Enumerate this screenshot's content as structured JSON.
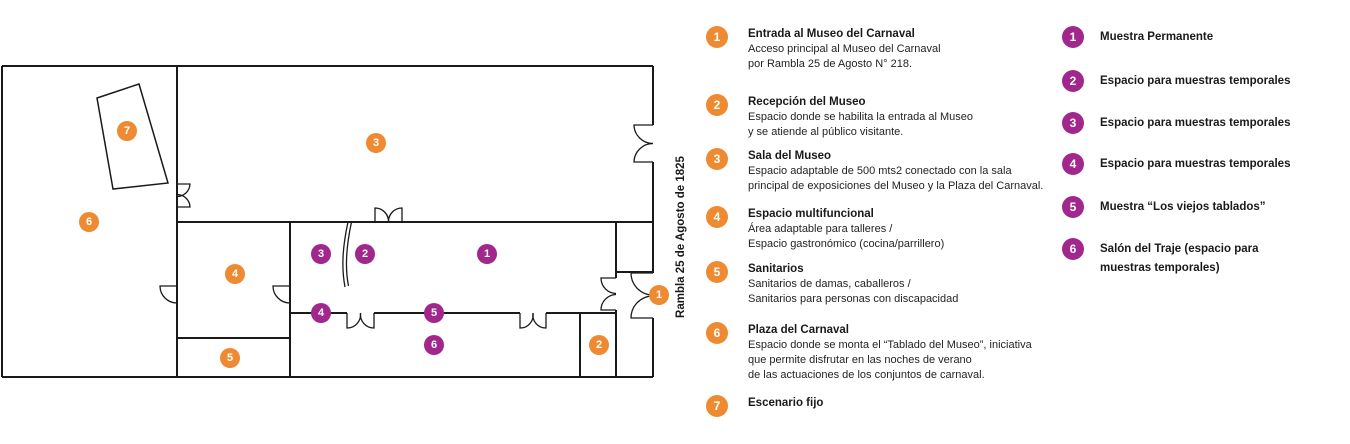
{
  "colors": {
    "orange": "#EE8A31",
    "purple": "#A1278D",
    "wall": "#1a1a1a"
  },
  "plan": {
    "street_label": "Rambla 25 de Agosto de 1825",
    "markers": [
      {
        "group": "orange",
        "label": "1",
        "x": 659,
        "y": 295
      },
      {
        "group": "orange",
        "label": "2",
        "x": 599,
        "y": 345
      },
      {
        "group": "orange",
        "label": "3",
        "x": 376,
        "y": 143
      },
      {
        "group": "orange",
        "label": "4",
        "x": 235,
        "y": 274
      },
      {
        "group": "orange",
        "label": "5",
        "x": 230,
        "y": 358
      },
      {
        "group": "orange",
        "label": "6",
        "x": 89,
        "y": 222
      },
      {
        "group": "orange",
        "label": "7",
        "x": 127,
        "y": 131
      },
      {
        "group": "purple",
        "label": "1",
        "x": 487,
        "y": 254
      },
      {
        "group": "purple",
        "label": "2",
        "x": 365,
        "y": 254
      },
      {
        "group": "purple",
        "label": "3",
        "x": 321,
        "y": 254
      },
      {
        "group": "purple",
        "label": "4",
        "x": 321,
        "y": 313
      },
      {
        "group": "purple",
        "label": "5",
        "x": 434,
        "y": 313
      },
      {
        "group": "purple",
        "label": "6",
        "x": 434,
        "y": 345
      }
    ]
  },
  "legend_orange": {
    "items": [
      {
        "num": "1",
        "title": "Entrada al Museo del Carnaval",
        "desc": [
          "Acceso principal al Museo del Carnaval",
          "por Rambla 25 de Agosto N° 218."
        ]
      },
      {
        "num": "2",
        "title": "Recepción del Museo",
        "desc": [
          "Espacio donde se habilita la entrada al Museo",
          "y se atiende al público visitante."
        ]
      },
      {
        "num": "3",
        "title": "Sala del Museo",
        "desc": [
          "Espacio adaptable de 500 mts2 conectado con la sala",
          "principal de exposiciones del Museo y la Plaza del Carnaval."
        ]
      },
      {
        "num": "4",
        "title": "Espacio multifuncional",
        "desc": [
          "Área adaptable para talleres /",
          "Espacio gastronómico (cocina/parrillero)"
        ]
      },
      {
        "num": "5",
        "title": "Sanitarios",
        "desc": [
          "Sanitarios de damas, caballeros /",
          "Sanitarios para personas con discapacidad"
        ]
      },
      {
        "num": "6",
        "title": "Plaza del Carnaval",
        "desc": [
          "Espacio donde se monta el “Tablado del Museo”, iniciativa",
          "que permite disfrutar en las noches de verano",
          "de las actuaciones de los conjuntos de carnaval."
        ]
      },
      {
        "num": "7",
        "title": "Escenario fijo",
        "desc": []
      }
    ]
  },
  "legend_purple": {
    "items": [
      {
        "num": "1",
        "lines": [
          "Muestra Permanente"
        ]
      },
      {
        "num": "2",
        "lines": [
          "Espacio para muestras temporales"
        ]
      },
      {
        "num": "3",
        "lines": [
          "Espacio para muestras temporales"
        ]
      },
      {
        "num": "4",
        "lines": [
          "Espacio para muestras temporales"
        ]
      },
      {
        "num": "5",
        "lines": [
          "Muestra “Los viejos tablados”"
        ]
      },
      {
        "num": "6",
        "lines": [
          "Salón del Traje (espacio para",
          "muestras temporales)"
        ]
      }
    ]
  }
}
